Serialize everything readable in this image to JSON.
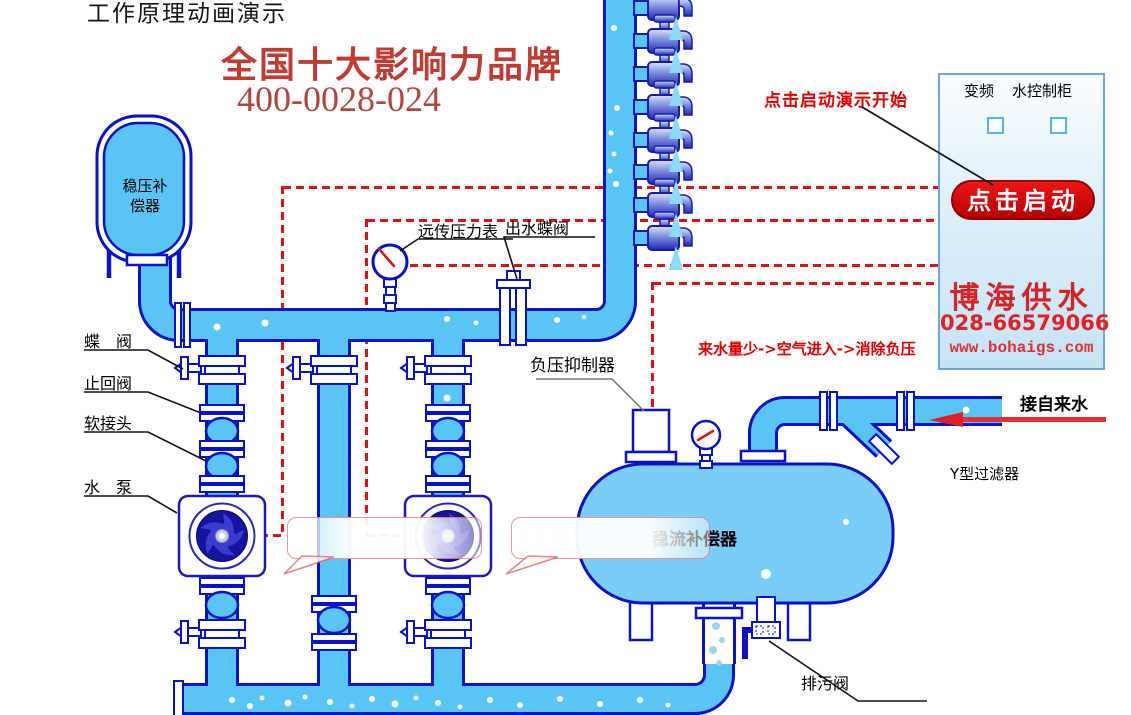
{
  "page_title": "工作原理动画演示",
  "brand": {
    "headline": "全国十大影响力品牌",
    "hotline": "400-0028-024"
  },
  "hints": {
    "start_hint": "点击启动演示开始",
    "flow_note": "来水量少->空气进入->消除负压"
  },
  "equipment_labels": {
    "surge_tank_line1": "稳压补",
    "surge_tank_line2": "偿器",
    "butterfly_valve": "蝶　阀",
    "check_valve": "止回阀",
    "soft_joint": "软接头",
    "water_pump": "水　泵",
    "remote_pressure_gauge": "远传压力表",
    "outlet_butterfly_valve": "出水蝶阀",
    "vacuum_suppressor": "负压抑制器",
    "flow_compensator": "稳流补偿器",
    "drain_valve": "排污阀",
    "y_strainer": "Y型过滤器",
    "tap_water_inlet": "接自来水"
  },
  "control_cabinet": {
    "label_vfd": "变频",
    "label_cabinet": "水控制柜",
    "start_button": "点击启动",
    "company": "博海供水",
    "phone": "028-66579066",
    "website": "www.bohaigs.com"
  },
  "colors": {
    "pipe_fill": "#58C5F4",
    "pipe_outline": "#0812CC",
    "tank_fill": "#7ACDF7",
    "wire_red": "#E01212",
    "brand_red": "#C23A30",
    "button_red": "#D40000",
    "spray_blue": "#8ADAF8"
  }
}
